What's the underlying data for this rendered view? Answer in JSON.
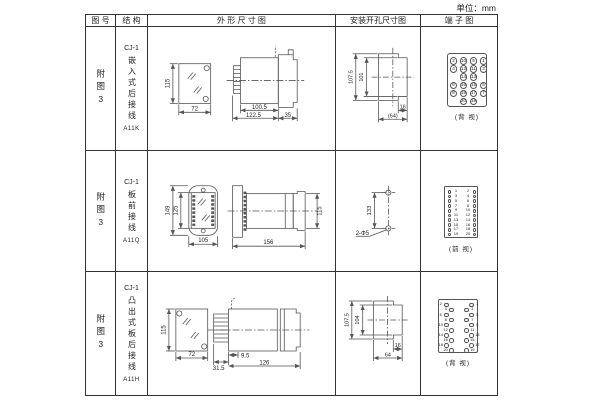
{
  "unit_label": "单位：mm",
  "colors": {
    "table_border": "#333333",
    "drawing_line": "#555555",
    "text": "#222222",
    "background": "#ffffff"
  },
  "table": {
    "headers": [
      "图 号",
      "结 构",
      "外 形 尺 寸 图",
      "安装开孔尺寸图",
      "端 子 图"
    ],
    "rows": [
      {
        "fig_no": "附图3",
        "structure_top": "CJ-1",
        "structure_main": "嵌入式后接线",
        "model": "A11K",
        "outline": {
          "front_h": "115",
          "front_w": "72",
          "d1": "100.5",
          "d2": "122.5",
          "d3": "35"
        },
        "mount": {
          "outer_v": "107.5",
          "inner_v": "101",
          "h1": "16",
          "h2": "(64)"
        },
        "terminal": {
          "type": "grid4",
          "caption": "(背 视)",
          "rows": [
            [
              "2",
              "10",
              "9",
              "1"
            ],
            [
              "4",
              "12",
              "11",
              "3"
            ],
            [
              "",
              "14",
              "13",
              ""
            ],
            [
              "6",
              "16",
              "15",
              "5"
            ],
            [
              "8",
              "18",
              "17",
              "7"
            ],
            [
              "",
              "20",
              "19",
              ""
            ]
          ]
        }
      },
      {
        "fig_no": "附图3",
        "structure_top": "CJ-1",
        "structure_main": "板前接线",
        "model": "A11Q",
        "outline": {
          "front_h": "149",
          "front_h2": "125",
          "front_w": "105",
          "side_l": "156",
          "side_h": "115"
        },
        "mount": {
          "v": "133",
          "hole_label": "2-Φ5"
        },
        "terminal": {
          "type": "pairs",
          "caption": "(前 视)",
          "pairs": [
            [
              "1",
              "2"
            ],
            [
              "3",
              "4"
            ],
            [
              "5",
              "6"
            ],
            [
              "7",
              "8"
            ],
            [
              "9",
              "10"
            ],
            [
              "11",
              "12"
            ],
            [
              "13",
              "14"
            ],
            [
              "15",
              "16"
            ],
            [
              "17",
              "18"
            ],
            [
              "19",
              "20"
            ]
          ]
        }
      },
      {
        "fig_no": "附图3",
        "structure_top": "CJ-1",
        "structure_main": "凸出式板后接线",
        "model": "A11H",
        "outline": {
          "front_h": "115",
          "front_w": "72",
          "d1": "9.5",
          "d2": "31.5",
          "d3": "126"
        },
        "mount": {
          "outer_v": "107.5",
          "inner_v": "104",
          "h1": "16",
          "h2": "64"
        },
        "terminal": {
          "type": "zigzag",
          "caption": "(背 视)",
          "left": [
            "2",
            "4",
            "6",
            "8",
            "10",
            "12",
            "14",
            "16",
            "18",
            "20"
          ],
          "right": [
            "1",
            "3",
            "5",
            "7",
            "9",
            "11",
            "13",
            "15",
            "17",
            "19"
          ]
        }
      }
    ]
  }
}
